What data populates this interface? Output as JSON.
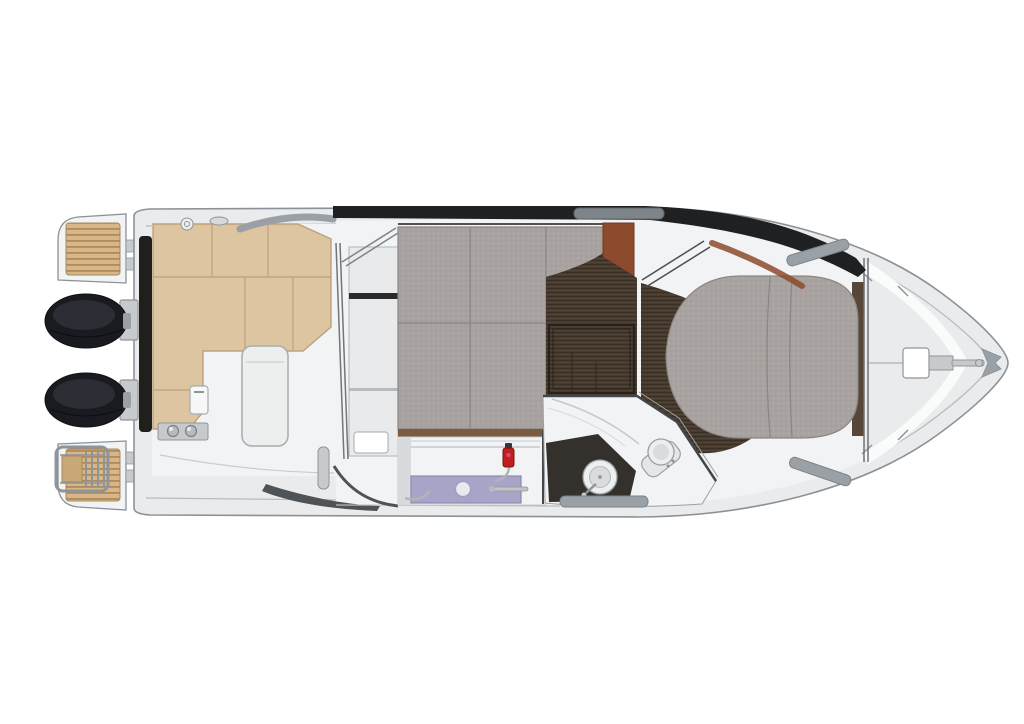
{
  "canvas": {
    "width": 1024,
    "height": 724
  },
  "scene": {
    "type": "boat-deck-plan",
    "view": "top-down",
    "orientation": "bow-right"
  },
  "colors": {
    "background": "#ffffff",
    "hullFill": "#e9ebec",
    "hullStroke": "#8b9297",
    "rimLine": "#b7bcc0",
    "interiorWhite": "#f2f3f4",
    "highlight": "#fafbfb",
    "black": "#1e2022",
    "teak": "#d7b689",
    "teakSlat": "#b08a58",
    "teakStep": "#c9a877",
    "engineBlack": "#191b20",
    "engineShine": "#2a2d34",
    "chrome": "#c6cacd",
    "metalStroke": "#8e959a",
    "benchTan": "#dcc5a0",
    "benchSeam": "#bda27a",
    "carpet": "#a8a3a0",
    "carpetDot": "#9c9794",
    "carpetDot2": "#b2adaa",
    "carpetEdge": "#8a8582",
    "wood": "#473b2f",
    "woodLine": "#3a2f24",
    "woodHighlight": "#584a3c",
    "woodEdgeDark": "#26231f",
    "sienna": "#8d4a2c",
    "trimBrown": "#7b5c42",
    "lavender": "#a8a4c8",
    "lavenderEdge": "#8d89ae",
    "red": "#c0201c",
    "magenta": "#d4488e",
    "capDark": "#3a3340",
    "fixture": "#edefef",
    "fixtureInner": "#d8dcdd",
    "fixtureStroke": "#9aa0a4",
    "wallDark": "#43474a",
    "headFloor": "#34312c",
    "shadow": "#4e5357",
    "rail": "#9aa1a6",
    "railDark": "#7c8287",
    "panelGray": "#e8eaeb",
    "lineGray": "#b0b5b9",
    "transomDark": "#211f1c",
    "woodSliver": "#564738"
  },
  "components": [
    "hull",
    "port-swim-platform",
    "starboard-swim-platform",
    "boarding-ladder",
    "port-outboard-engine",
    "starboard-outboard-engine",
    "transom",
    "cockpit-floor",
    "cockpit-bench",
    "cockpit-table",
    "fuel-filler-caps",
    "cabin-bulkhead-door",
    "aft-cabin-berth",
    "companionway-steps",
    "saloon-wood-floor",
    "floor-hatch",
    "galley-cabinet",
    "galley-counter",
    "galley-sink",
    "fire-extinguisher",
    "head-compartment",
    "head-sink",
    "toilet",
    "shower-floor",
    "bow-cabin-berth",
    "bow-cabin-floor",
    "bow-bulkhead",
    "foredeck",
    "anchor-locker",
    "anchor",
    "windshield-band",
    "grab-rails"
  ]
}
